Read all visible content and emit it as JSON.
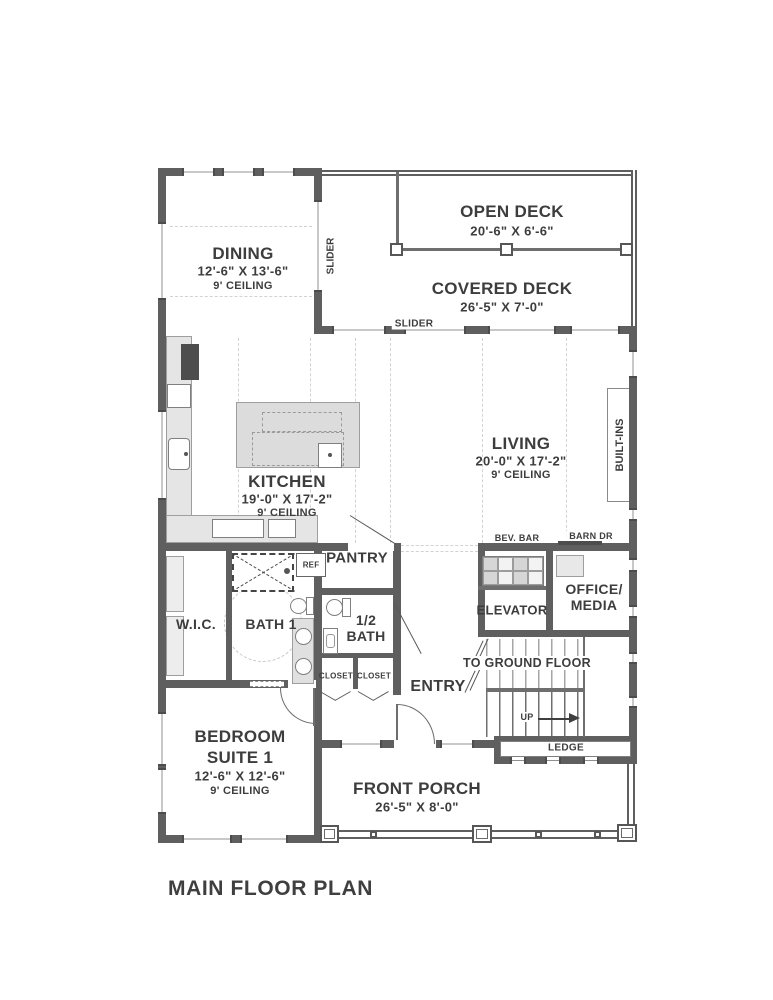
{
  "title": "MAIN FLOOR PLAN",
  "colors": {
    "wall": "#5f5f5f",
    "text": "#3d3d3d",
    "counter": "#e5e5e5",
    "island": "#dcdcdc"
  },
  "rooms": {
    "open_deck": {
      "name": "OPEN DECK",
      "dims": "20'-6\" X 6'-6\""
    },
    "covered_deck": {
      "name": "COVERED DECK",
      "dims": "26'-5\" X 7'-0\""
    },
    "dining": {
      "name": "DINING",
      "dims": "12'-6\" X 13'-6\"",
      "ceiling": "9' CEILING"
    },
    "living": {
      "name": "LIVING",
      "dims": "20'-0\" X 17'-2\"",
      "ceiling": "9' CEILING"
    },
    "kitchen": {
      "name": "KITCHEN",
      "dims": "19'-0\" X 17'-2\"",
      "ceiling": "9' CEILING"
    },
    "bedroom": {
      "name": "BEDROOM",
      "name2": "SUITE 1",
      "dims": "12'-6\" X 12'-6\"",
      "ceiling": "9' CEILING"
    },
    "front_porch": {
      "name": "FRONT PORCH",
      "dims": "26'-5\" X 8'-0\""
    },
    "office": {
      "line1": "OFFICE/",
      "line2": "MEDIA"
    },
    "half_bath": {
      "line1": "1/2",
      "line2": "BATH"
    },
    "pantry": {
      "name": "PANTRY"
    },
    "elevator": {
      "name": "ELEVATOR"
    },
    "wic": {
      "name": "W.I.C."
    },
    "bath1": {
      "name": "BATH 1"
    },
    "entry": {
      "name": "ENTRY"
    }
  },
  "labels": {
    "slider_top": "SLIDER",
    "slider_side": "SLIDER",
    "ref": "REF",
    "bev_bar": "BEV. BAR",
    "barn_dr": "BARN DR",
    "built_ins": "BUILT-INS",
    "closet_left": "CLOSET",
    "closet_right": "CLOSET",
    "to_ground_floor": "TO GROUND FLOOR",
    "up": "UP",
    "ledge": "LEDGE"
  }
}
